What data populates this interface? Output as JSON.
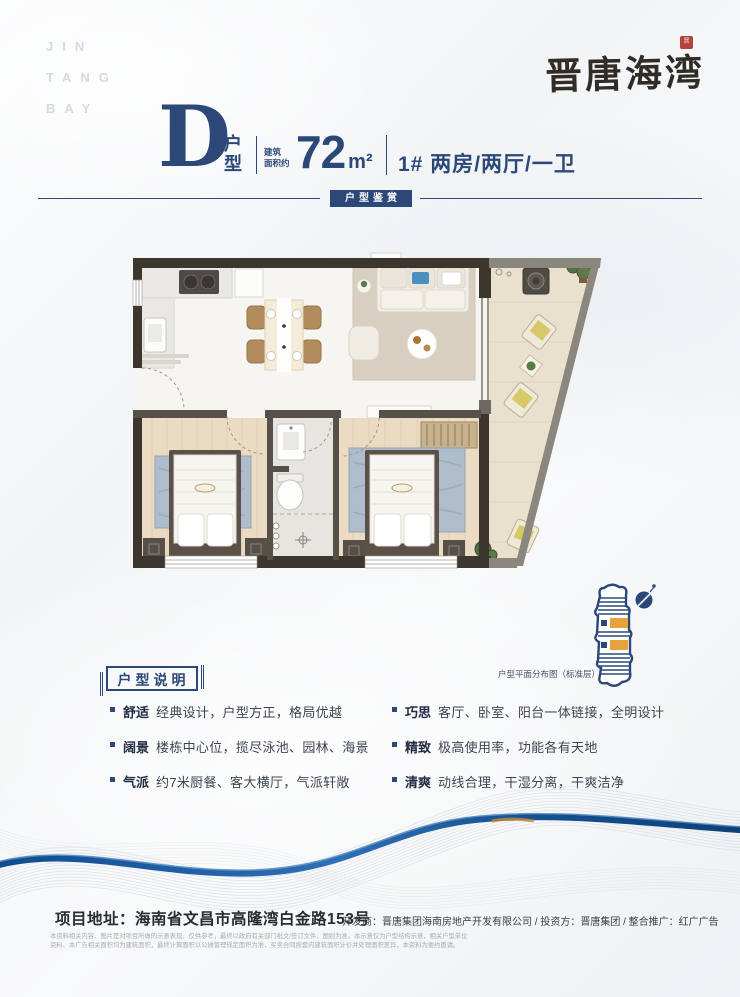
{
  "brand": {
    "watermark": [
      "JIN",
      "TANG",
      "BAY"
    ],
    "logo_text": "晋唐海湾",
    "seal_text": "晋"
  },
  "title": {
    "unit_letter": "D",
    "unit_label": "户型",
    "area_prefix": [
      "建筑",
      "面积约"
    ],
    "area_value": "72",
    "area_unit": "m²",
    "spec": "1#  两房/两厅/一卫",
    "banner": "户型鉴赏"
  },
  "plan": {
    "distribution_caption": "户型平面分布图（标准层）"
  },
  "description": {
    "header": "户型说明",
    "items_left": [
      {
        "keyword": "舒适",
        "text": "经典设计，户型方正，格局优越"
      },
      {
        "keyword": "阔景",
        "text": "楼栋中心位，揽尽泳池、园林、海景"
      },
      {
        "keyword": "气派",
        "text": "约7米厨餐、客大横厅，气派轩敞"
      }
    ],
    "items_right": [
      {
        "keyword": "巧思",
        "text": "客厅、卧室、阳台一体链接，全明设计"
      },
      {
        "keyword": "精致",
        "text": "极高使用率，功能各有天地"
      },
      {
        "keyword": "清爽",
        "text": "动线合理，干湿分离，干爽洁净"
      }
    ]
  },
  "footer": {
    "address_full": "项目地址：海南省文昌市高隆湾白金路153号",
    "credits": "开发商：晋唐集团海南房地产开发有限公司  /  投资方：晋唐集团  /  整合推广：红广广告",
    "disclaimer_line1": "本资料相关内容、图片是对项目所做的示意表现，仅供参考，最终以政府有关部门批文/签订文件、图则为准。本示意仅为户型结构示意，相关户型单位",
    "disclaimer_line2": "资料、本广告相关面积均为建筑面积，最终计算面积以公摊管理规定面积为准，买卖合同按套内建筑面积计价并处理面积差异，本资料为要约邀请。"
  },
  "colors": {
    "navy": "#2b4878",
    "orange": "#e8a23c",
    "seal_red": "#b2423a",
    "wave_blue": "#1b5a9e"
  }
}
